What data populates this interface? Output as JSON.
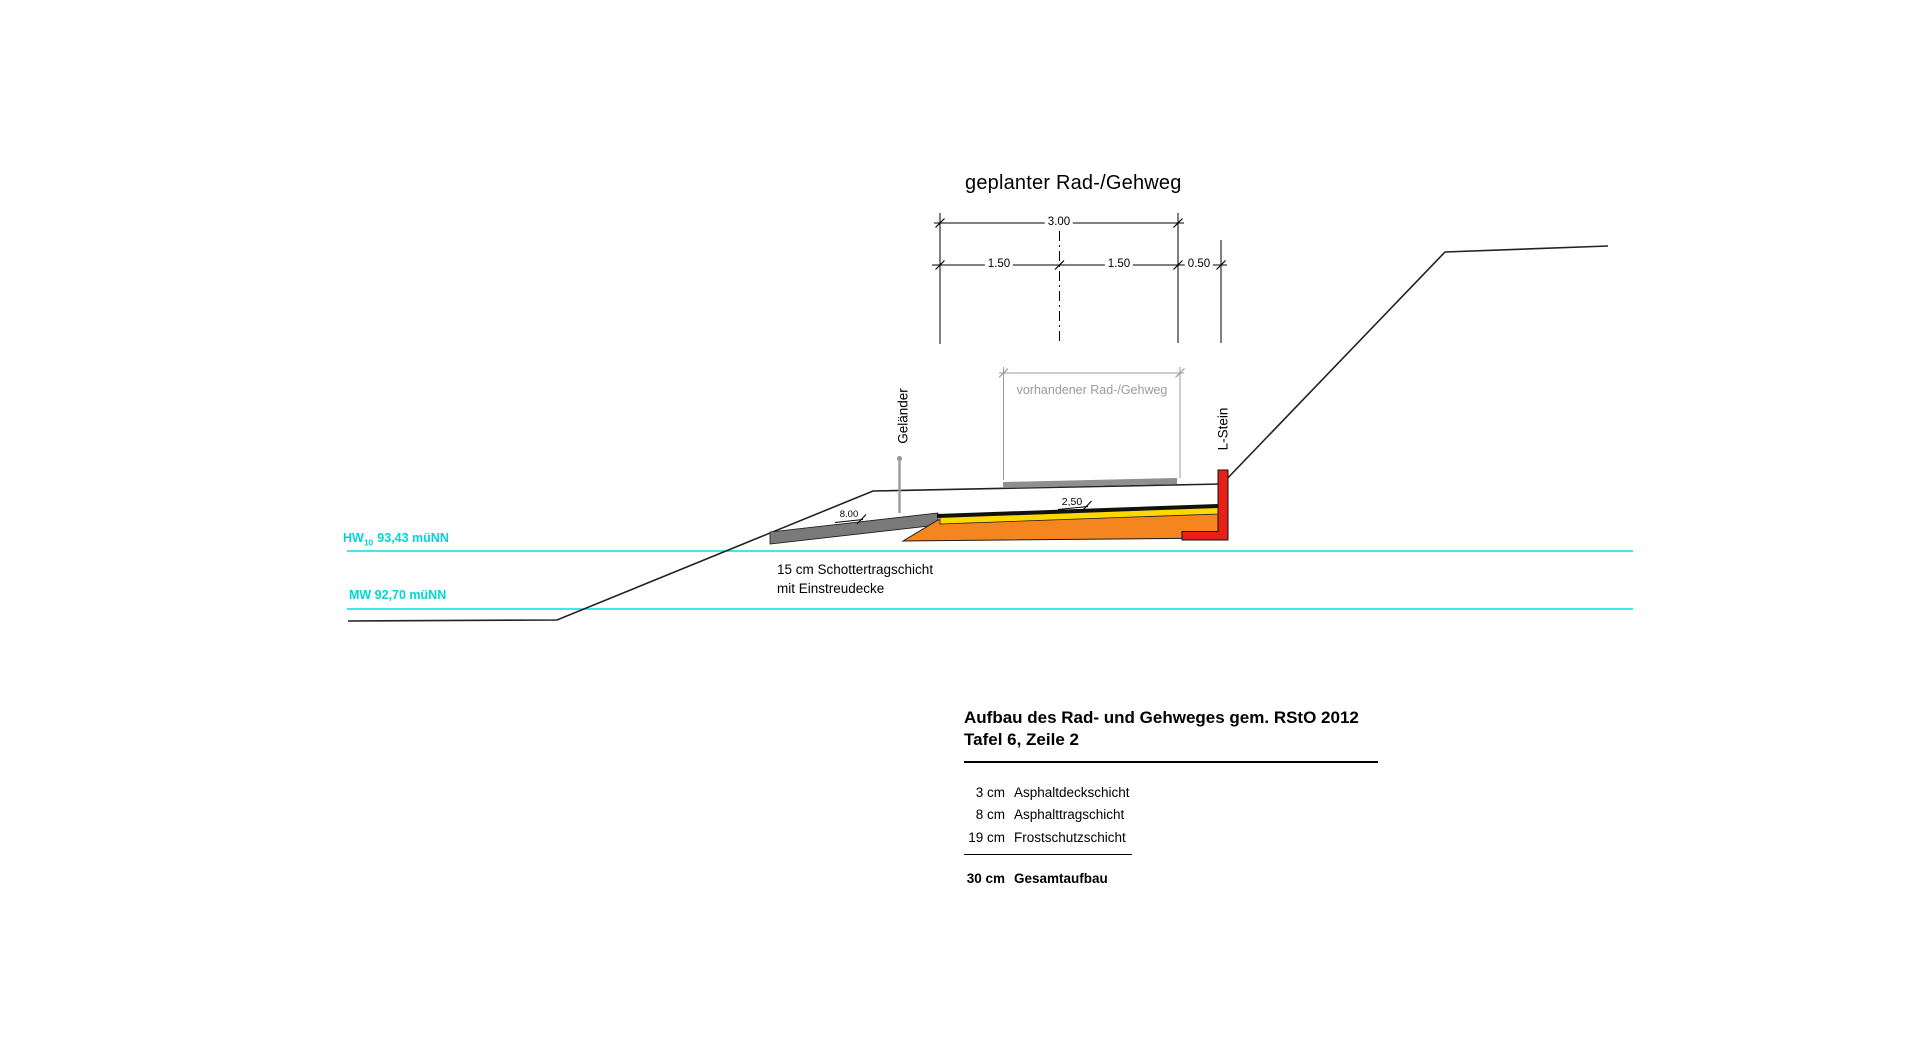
{
  "drawing": {
    "title": "geplanter Rad-/Gehweg",
    "dimensions": {
      "total": "3.00",
      "left_half": "1.50",
      "right_half": "1.50",
      "edge_strip": "0.50"
    },
    "existing_path_label": "vorhandener Rad-/Gehweg",
    "railing_label": "Geländer",
    "lstone_label": "L-Stein",
    "slope_ramp": "8.00",
    "slope_path": "2,50",
    "note_line1": "15 cm Schottertragschicht",
    "note_line2": "mit Einstreudecke"
  },
  "water_levels": {
    "hw": {
      "prefix": "HW",
      "sub": "10",
      "value": "93,43 müNN"
    },
    "mw": "MW 92,70 müNN"
  },
  "table": {
    "title_line1": "Aufbau des Rad- und Gehweges gem. RStO 2012",
    "title_line2": "Tafel 6, Zeile 2",
    "rows": [
      {
        "value": "3 cm",
        "label": "Asphaltdeckschicht"
      },
      {
        "value": "8 cm",
        "label": "Asphalttragschicht"
      },
      {
        "value": "19 cm",
        "label": "Frostschutzschicht"
      }
    ],
    "total": {
      "value": "30 cm",
      "label": "Gesamtaufbau"
    }
  },
  "colors": {
    "cyan": "#00e2e2",
    "orange": "#f5851f",
    "yellow": "#ffd800",
    "red": "#e8201a",
    "ramp_gray": "#7a7a7a",
    "existing_path_gray": "#8f8f8f",
    "dim_gray": "#9b9b9b",
    "railing_gray": "#9a9a9a",
    "line_black": "#1a1a1a"
  }
}
